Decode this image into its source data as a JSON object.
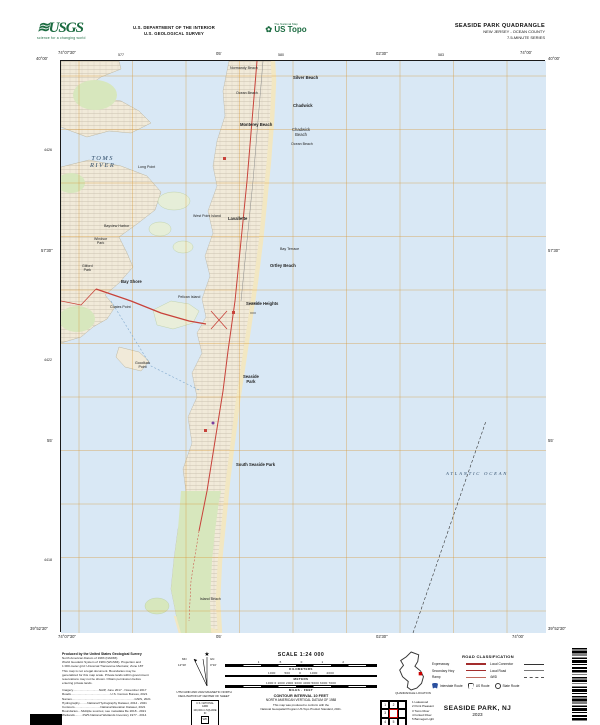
{
  "header": {
    "usgs": "USGS",
    "usgs_tagline": "science for a changing world",
    "dept1": "U.S. DEPARTMENT OF THE INTERIOR",
    "dept2": "U.S. GEOLOGICAL SURVEY",
    "tnm": "The National Map",
    "ustopo": "US Topo",
    "quad": "SEASIDE PARK QUADRANGLE",
    "state_county": "NEW JERSEY - OCEAN COUNTY",
    "series": "7.5-MINUTE SERIES"
  },
  "collar": {
    "nw_lat": "40°00'",
    "nw_lon": "74°07'30\"",
    "ne_lat": "40°00'",
    "ne_lon": "74°00'",
    "sw_lat": "39°52'30\"",
    "sw_lon": "74°07'30\"",
    "se_lat": "39°52'30\"",
    "se_lon": "74°00'",
    "top_tick1": "05'",
    "top_tick2": "02'30\"",
    "bottom_tick1": "05'",
    "bottom_tick2": "02'30\"",
    "left_tick1": "57'30\"",
    "left_tick2": "55'",
    "right_tick1": "57'30\"",
    "right_tick2": "55'",
    "utm_top": [
      "577",
      "580",
      "583"
    ],
    "utm_left": [
      "4426",
      "4422",
      "4418"
    ]
  },
  "map_labels": {
    "normandy_beach": "Normandy Beach",
    "silver_beach": "Silver Beach",
    "ocean_beach_n": "Ocean Beach",
    "chadwick": "Chadwick",
    "monterey_beach": "Monterey Beach",
    "chadwick_beach": "Chadwick\nBeach",
    "ocean_beach_s": "Ocean Beach",
    "west_point_island": "West Point Island",
    "lavallette": "Lavallette",
    "bay_terrace": "Bay Terrace",
    "ortley_beach": "Ortley Beach",
    "seaside_heights": "Seaside Heights",
    "seaside_park": "Seaside\nPark",
    "south_seaside_park": "South Seaside Park",
    "island_beach": "Island Beach",
    "toms_river": "TOMS\nRIVER",
    "long_point": "Long Point",
    "bayview_harbor": "Bayview Harbor",
    "windsor_park": "Windsor\nPark",
    "gilford_park": "Gilford\nPark",
    "bay_shore": "Bay Shore",
    "coates_point": "Coates Point",
    "goodluck_point": "Goodluck\nPoint",
    "pelican_island": "Pelican Island",
    "atlantic_ocean": "ATLANTIC OCEAN"
  },
  "footer": {
    "credits_title": "Produced by the United States Geological Survey",
    "credits_body": "North American Datum of 1983 (NAD83)\nWorld Geodetic System of 1984 (WGS84). Projection and\n1 000-meter grid: Universal Transverse Mercator, Zone 18T\nThis map is not a legal document. Boundaries may be\ngeneralized for this map scale. Private lands within government\nreservations may not be shown. Obtain permission before\nentering private lands.",
    "sources": "Imagery..............................NAIP, June 2017 - November 2017\nRoads..............................................U.S. Census Bureau, 2021\nNames.........................................................................GNIS, 2021\nHydrography.........National Hydrography Dataset, 2014 - 2021\nContours..............................National Elevation Dataset, 2021\nBoundaries....Multiple sources; see metadata file 2018 - 2021\nWetlands.........FWS National Wetlands Inventory 1977 - 2014",
    "decl_caption": "UTM GRID AND 2022 MAGNETIC NORTH\nDECLINATION AT CENTER OF SHEET",
    "decl_gn": "GN",
    "decl_gn_val": "0°16'",
    "decl_mn": "MN",
    "decl_mn_val": "12°30'",
    "usng": {
      "t1": "U.S. NATIONAL GRID",
      "t2": "100,000-m SQUARE ID",
      "sq": "WK",
      "t3": "GRID ZONE DESIGNATION",
      "t4": "18T"
    },
    "scale": {
      "title": "SCALE 1:24 000",
      "km_nums": "1    .5    0    1    2",
      "km_label": "KILOMETERS",
      "m_nums": "1000    500    0    1000    2000",
      "m_label": "METERS",
      "mi_label": "MILES",
      "ft_nums": "1000  0  1000  2000  3000  4000  5000  6000  7000",
      "ft_label": "FEET"
    },
    "contour1": "CONTOUR INTERVAL 10 FEET",
    "contour2": "NORTH AMERICAN VERTICAL DATUM OF 1988",
    "conform": "This map was produced to conform with the\nNational Geospatial Program US Topo Product Standard, 2021.",
    "quad_loc": "QUADRANGLE LOCATION",
    "adjoining_caption": "ADJOINING 7.5' QUADRANGLE NAMES",
    "adjoining_cells": [
      "1",
      "2",
      "3",
      "4",
      "5"
    ],
    "adjoining_names": "1 Lakewood\n2 Point Pleasant\n3 Toms River\n4 Forked River\n5 Barnegat Light",
    "road": {
      "title": "ROAD CLASSIFICATION",
      "expressway": "Expressway",
      "secondary": "Secondary Hwy",
      "ramp": "Ramp",
      "local_connector": "Local Connector",
      "local_road": "Local Road",
      "fwd": "4WD",
      "interstate": "Interstate Route",
      "us_route": "US Route",
      "state_route": "State Route"
    },
    "sheet_title": "SEASIDE PARK, NJ",
    "sheet_year": "2023"
  }
}
